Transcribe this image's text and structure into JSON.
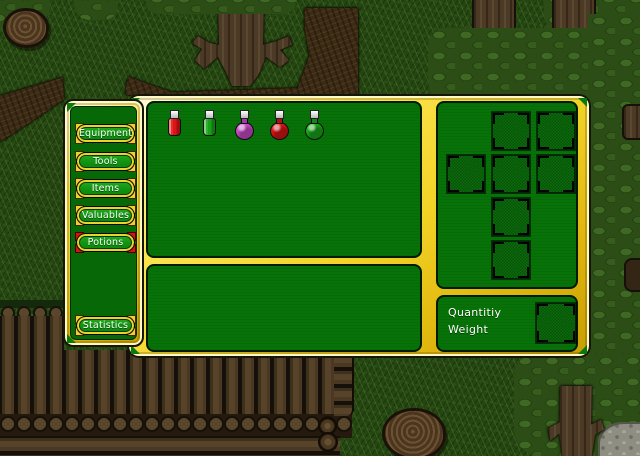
{
  "sidebar": {
    "buttons": [
      {
        "label": "Equipment",
        "selected": false
      },
      {
        "label": "Tools",
        "selected": false
      },
      {
        "label": "Items",
        "selected": false
      },
      {
        "label": "Valuables",
        "selected": false
      },
      {
        "label": "Potions",
        "selected": true
      }
    ],
    "statistics": {
      "label": "Statistics",
      "selected": false
    },
    "selected_category": "Potions"
  },
  "items_panel": {
    "items": [
      {
        "name": "red-vial-potion",
        "shape": "vial",
        "color": "#de1414"
      },
      {
        "name": "green-vial-potion",
        "shape": "vial",
        "color": "#17a317"
      },
      {
        "name": "purple-flask-potion",
        "shape": "flask",
        "color": "#cc49cc"
      },
      {
        "name": "red-flask-potion",
        "shape": "flask",
        "color": "#de1414"
      },
      {
        "name": "green-flask-potion",
        "shape": "flask",
        "color": "#18a918"
      }
    ]
  },
  "equipment_panel": {
    "slot_count": 7
  },
  "info_panel": {
    "labels": {
      "quantity": "Quantitiy",
      "weight": "Weight"
    }
  },
  "colors": {
    "panel_green": "#077207",
    "gold": "#f3d327",
    "selected_corner_red": "#d41414",
    "slot_checker_dark": "#085208",
    "button_green": "#119211"
  }
}
